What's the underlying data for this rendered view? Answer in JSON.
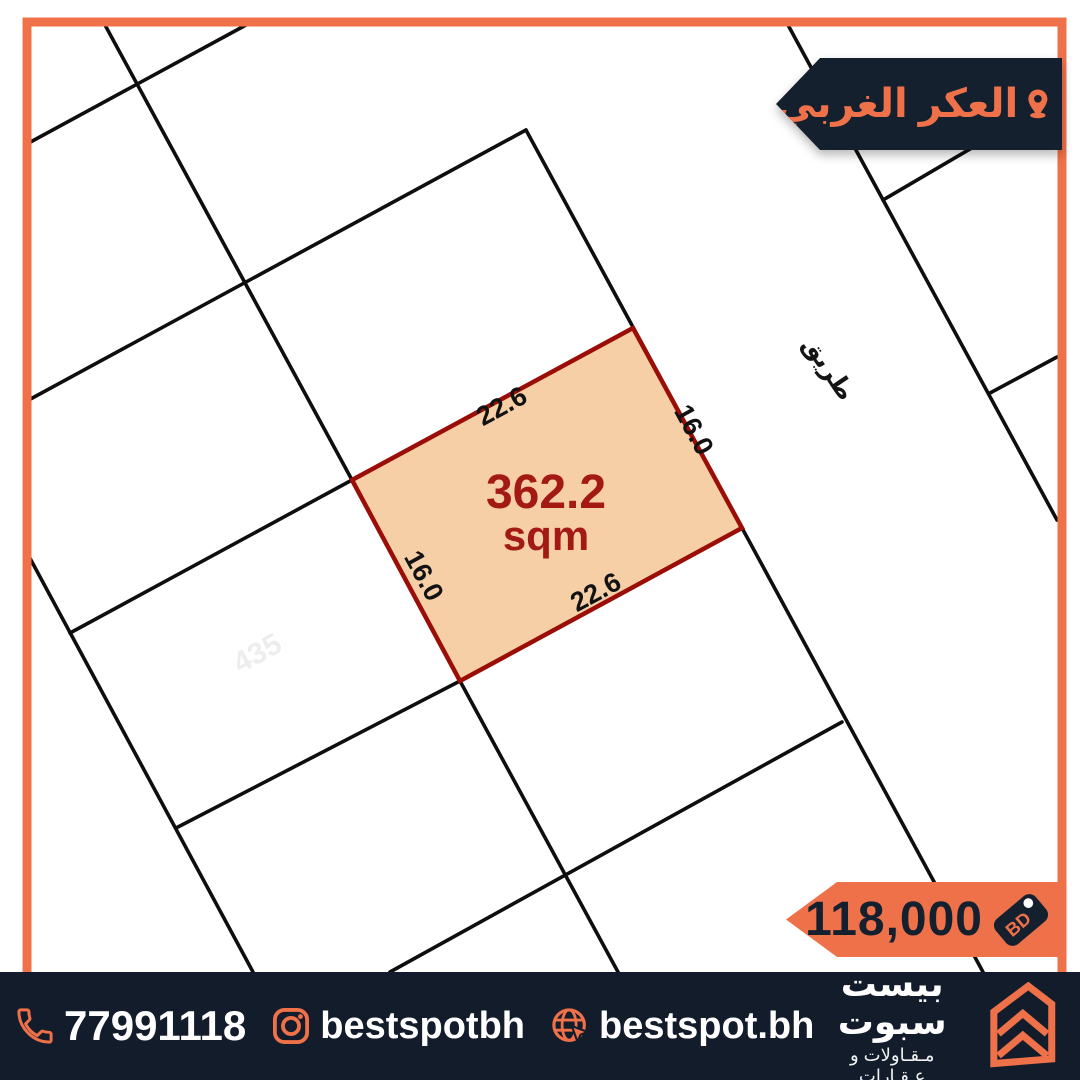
{
  "theme": {
    "accent": "#EF714A",
    "navy": "#15202F",
    "footer-bg": "#131C2B",
    "map-line": "#0E0E0E",
    "plot-fill": "#F6CFA7",
    "plot-border": "#9B0E08",
    "plot-text": "#A31914",
    "map-bg": "#FFFFFF"
  },
  "location_banner": {
    "label": "العكر الغربي",
    "icon": "location-pin-icon"
  },
  "price_banner": {
    "amount": "118,000",
    "currency": "BD",
    "icon": "price-tag-icon"
  },
  "map": {
    "road_label": "طريق",
    "ghost_label": "435",
    "plot": {
      "area_value": "362.2",
      "area_unit": "sqm",
      "dim_top": "22.6",
      "dim_right": "16.0",
      "dim_bottom": "22.6",
      "dim_left": "16.0"
    },
    "lines": [
      [
        105,
        25,
        352,
        480
      ],
      [
        460,
        681,
        618,
        972
      ],
      [
        25,
        549,
        253,
        972
      ],
      [
        526,
        130,
        983,
        972
      ],
      [
        788,
        25,
        1057,
        520
      ],
      [
        25,
        145,
        246,
        25
      ],
      [
        25,
        402,
        526,
        130
      ],
      [
        70,
        633,
        352,
        480
      ],
      [
        883,
        200,
        1057,
        98
      ],
      [
        176,
        828,
        460,
        681
      ],
      [
        990,
        393,
        1057,
        357
      ],
      [
        842,
        722,
        390,
        972
      ]
    ]
  },
  "footer": {
    "phone": "77991118",
    "instagram": "bestspotbh",
    "website": "bestspot.bh",
    "brand_name": "بيست سبوت",
    "brand_tagline": "مـقـاولات و عـقـارات"
  }
}
